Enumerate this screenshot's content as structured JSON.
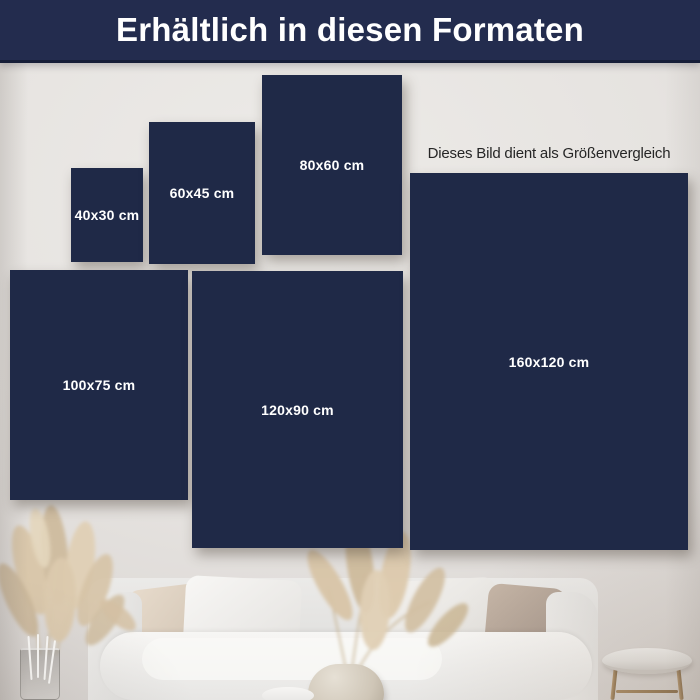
{
  "header": {
    "title": "Erhältlich in diesen Formaten"
  },
  "note": {
    "text": "Dieses Bild dient als Größenvergleich"
  },
  "formats": [
    {
      "label": "40x30 cm",
      "left": 71,
      "top": 168,
      "width": 72,
      "height": 94
    },
    {
      "label": "60x45 cm",
      "left": 149,
      "top": 122,
      "width": 106,
      "height": 142
    },
    {
      "label": "80x60 cm",
      "left": 262,
      "top": 75,
      "width": 140,
      "height": 180
    },
    {
      "label": "100x75 cm",
      "left": 10,
      "top": 270,
      "width": 178,
      "height": 230
    },
    {
      "label": "120x90 cm",
      "left": 192,
      "top": 271,
      "width": 211,
      "height": 277
    },
    {
      "label": "160x120 cm",
      "left": 410,
      "top": 173,
      "width": 278,
      "height": 377
    }
  ],
  "colors": {
    "header_bg": "#232c4e",
    "header_text": "#ffffff",
    "tile": "#1f2947",
    "tile_text": "#ffffff",
    "note_text": "#262626",
    "wall": "#e7e4e1"
  },
  "scene": {
    "description": "white sofa with cushions, pampas grass in vases, round marble side table"
  }
}
